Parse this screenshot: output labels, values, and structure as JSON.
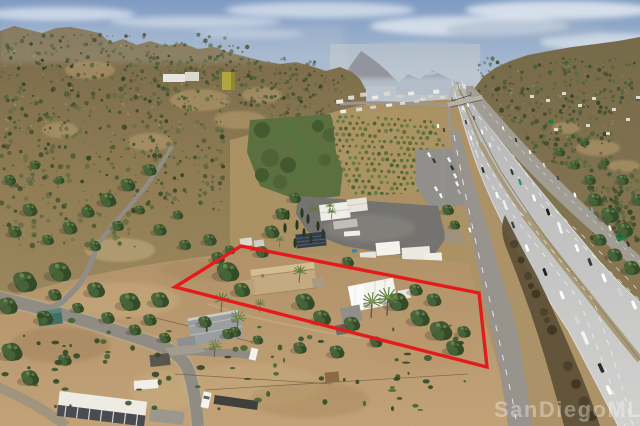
{
  "meta": {
    "type": "aerial-photograph",
    "subject": "oblique drone photo of a rural hillside property outlined in red beside a multi-lane freeway"
  },
  "watermark": {
    "text": "SanDiegoMLS®"
  },
  "colors": {
    "parcel_outline": "#e51a1a",
    "sky_top": "#7d9ac2",
    "sky_horizon": "#c5cdd6",
    "hillside": "#8a7852",
    "dirt": "#b59570",
    "scrub_green": "#43522f",
    "freeway_pavement": "#c3c4c2",
    "freeway_median": "#a39478",
    "green_sign": "#1d7a3c",
    "teal_shed": "#3e6e62",
    "tan_roof": "#c2a87e",
    "white_roof": "#f4f4f0",
    "neighbor_roof": "#999c9c"
  },
  "scene": {
    "elements": [
      "sky",
      "clouds",
      "distant-valley-haze",
      "left-mountains",
      "right-mountains",
      "hilltop-house",
      "water-tower",
      "winding-hill-road",
      "village-houses",
      "orchard-rows",
      "nursery-groves",
      "parking-lot",
      "estate-compound",
      "solar-array",
      "freeway",
      "freeway-median",
      "freeway-vehicles",
      "overpass-bridge",
      "east-frontage-road",
      "west-frontage-road",
      "green-highway-sign",
      "brush-embankment",
      "subject-parcel-red-outline",
      "subject-house-tan-roof",
      "subject-house-white-roof",
      "neighbor-house",
      "palm-trees",
      "oak-trees",
      "teal-shed",
      "white-barn",
      "rv-trailer",
      "pickup-truck",
      "flatbed-trailer",
      "dirt-roads",
      "watermark"
    ]
  }
}
